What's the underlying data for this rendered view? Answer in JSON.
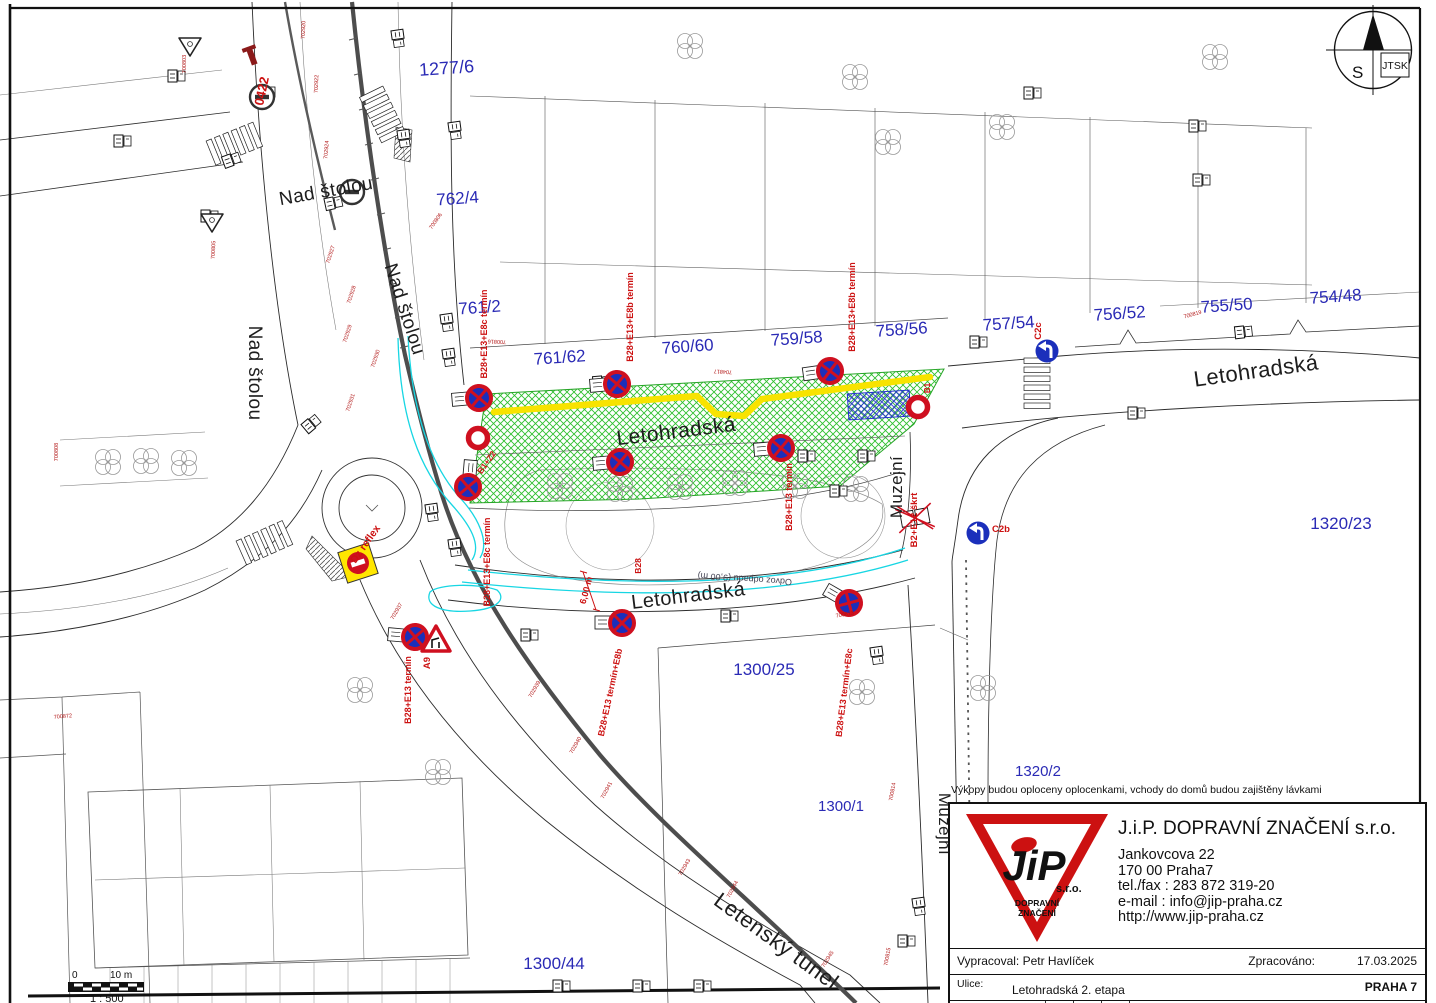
{
  "colors": {
    "parcel_blue": "#2a2ab5",
    "sign_red": "#cf1020",
    "label_red": "#cc1111",
    "sign_blue": "#1b2fbb",
    "workzone_green": "#2fbf2f",
    "closure_yellow": "#f8e300",
    "detour_cyan": "#17d6e3",
    "logo_red": "#cc1111"
  },
  "compass": {
    "s_label": "S",
    "grid_label": "JTSK"
  },
  "scale_bar": {
    "zero": "0",
    "ten": "10 m",
    "ratio": "1 : 500"
  },
  "note": "Výkopy budou oploceny oplocenkami, vchody do domů budou zajištěny lávkami",
  "title_block": {
    "company": "J.i.P. DOPRAVNÍ ZNAČENÍ s.r.o.",
    "address_lines": [
      "Jankovcova 22",
      "170 00 Praha7",
      "tel./fax : 283 872 319-20",
      "e-mail : info@jip-praha.cz",
      "http://www.jip-praha.cz"
    ],
    "logo": {
      "text": "JiP",
      "sro": "s.r.o.",
      "line1": "DOPRAVNÍ",
      "line2": "ZNAČENÍ"
    },
    "prepared_by_label": "Vypracoval:",
    "prepared_by": "Petr Havlíček",
    "processed_label": "Zpracováno:",
    "processed_date": "17.03.2025",
    "street_label": "Ulice:",
    "street": "Letohradská 2. etapa",
    "city": "PRAHA 7",
    "sheet_label": "Číslo listu",
    "sheet_number": "1"
  },
  "map": {
    "parcels": [
      {
        "t": "1277/6",
        "x": 447,
        "y": 74,
        "r": -4,
        "s": 18
      },
      {
        "t": "762/4",
        "x": 458,
        "y": 204,
        "r": -4,
        "s": 17
      },
      {
        "t": "761/2",
        "x": 480,
        "y": 313,
        "r": -4,
        "s": 17
      },
      {
        "t": "761/62",
        "x": 560,
        "y": 363,
        "r": -4,
        "s": 17
      },
      {
        "t": "760/60",
        "x": 688,
        "y": 352,
        "r": -4,
        "s": 17
      },
      {
        "t": "759/58",
        "x": 797,
        "y": 344,
        "r": -4,
        "s": 17
      },
      {
        "t": "758/56",
        "x": 902,
        "y": 335,
        "r": -4,
        "s": 17
      },
      {
        "t": "757/54",
        "x": 1009,
        "y": 329,
        "r": -4,
        "s": 17
      },
      {
        "t": "756/52",
        "x": 1120,
        "y": 319,
        "r": -4,
        "s": 17
      },
      {
        "t": "755/50",
        "x": 1227,
        "y": 311,
        "r": -4,
        "s": 17
      },
      {
        "t": "754/48",
        "x": 1336,
        "y": 302,
        "r": -4,
        "s": 17
      },
      {
        "t": "1320/23",
        "x": 1341,
        "y": 529,
        "r": 0,
        "s": 17
      },
      {
        "t": "1320/2",
        "x": 1038,
        "y": 776,
        "r": 0,
        "s": 15
      },
      {
        "t": "1300/25",
        "x": 764,
        "y": 675,
        "r": 0,
        "s": 17
      },
      {
        "t": "1300/1",
        "x": 841,
        "y": 811,
        "r": 0,
        "s": 15
      },
      {
        "t": "1300/44",
        "x": 554,
        "y": 969,
        "r": 0,
        "s": 17
      }
    ],
    "street_labels": [
      {
        "t": "Nad štolou",
        "x": 327,
        "y": 197,
        "r": -10,
        "s": 19
      },
      {
        "t": "Nad štolou",
        "x": 249,
        "y": 373,
        "r": 90,
        "s": 19
      },
      {
        "t": "Nad štolou",
        "x": 399,
        "y": 311,
        "r": 72,
        "s": 19
      },
      {
        "t": "Letohradská",
        "x": 677,
        "y": 438,
        "r": -7,
        "s": 21
      },
      {
        "t": "Letohradská",
        "x": 1257,
        "y": 378,
        "r": -8,
        "s": 22
      },
      {
        "t": "Letohradská",
        "x": 689,
        "y": 602,
        "r": -7,
        "s": 20
      },
      {
        "t": "Muzejní",
        "x": 902,
        "y": 487,
        "r": -90,
        "s": 17
      },
      {
        "t": "Muzejní",
        "x": 939,
        "y": 824,
        "r": 90,
        "s": 17
      },
      {
        "t": "Letenský tunel",
        "x": 772,
        "y": 947,
        "r": 36,
        "s": 22
      }
    ],
    "red_labels": [
      {
        "t": "0422",
        "x": 266,
        "y": 92,
        "r": -78,
        "s": 13
      },
      {
        "t": "B28+E13+E8c termín",
        "x": 487,
        "y": 334,
        "r": -90,
        "s": 9
      },
      {
        "t": "B28+E13+E8b termín",
        "x": 633,
        "y": 317,
        "r": -90,
        "s": 9
      },
      {
        "t": "B28+E13+E8b termín",
        "x": 855,
        "y": 307,
        "r": -90,
        "s": 9
      },
      {
        "t": "C2c",
        "x": 1041,
        "y": 331,
        "r": -90,
        "s": 9.5
      },
      {
        "t": "B1+Z2",
        "x": 489,
        "y": 464,
        "r": -55,
        "s": 8.5
      },
      {
        "t": "B28+E13+E8c termín",
        "x": 490,
        "y": 562,
        "r": -90,
        "s": 9
      },
      {
        "t": "B28+E13 termín",
        "x": 792,
        "y": 497,
        "r": -90,
        "s": 9
      },
      {
        "t": "B2+E12 škrt",
        "x": 917,
        "y": 520,
        "r": -90,
        "s": 9.5
      },
      {
        "t": "Dz reflex",
        "x": 368,
        "y": 546,
        "r": -55,
        "s": 10.5
      },
      {
        "t": "B28+E13 termín",
        "x": 411,
        "y": 690,
        "r": -90,
        "s": 9
      },
      {
        "t": "A9",
        "x": 430,
        "y": 663,
        "r": -90,
        "s": 9.5
      },
      {
        "t": "B28+E13 termín+E8b",
        "x": 613,
        "y": 693,
        "r": -78,
        "s": 9
      },
      {
        "t": "B28+E13 termín+E8c",
        "x": 847,
        "y": 693,
        "r": -83,
        "s": 9
      },
      {
        "t": "C2b",
        "x": 1001,
        "y": 532,
        "r": 0,
        "s": 9.5
      },
      {
        "t": "B1",
        "x": 930,
        "y": 388,
        "r": -90,
        "s": 8
      },
      {
        "t": "6,00 m",
        "x": 589,
        "y": 591,
        "r": -75,
        "s": 9
      },
      {
        "t": "B28",
        "x": 641,
        "y": 566,
        "r": -90,
        "s": 8.5
      }
    ],
    "survey_points": [
      {
        "t": "702920",
        "x": 305,
        "y": 30,
        "r": -88
      },
      {
        "t": "702922",
        "x": 318,
        "y": 84,
        "r": -88
      },
      {
        "t": "702924",
        "x": 328,
        "y": 150,
        "r": -85
      },
      {
        "t": "700803",
        "x": 186,
        "y": 64,
        "r": -90
      },
      {
        "t": "700805",
        "x": 215,
        "y": 250,
        "r": -88
      },
      {
        "t": "700806",
        "x": 437,
        "y": 222,
        "r": -55
      },
      {
        "t": "700808",
        "x": 58,
        "y": 452,
        "r": -90
      },
      {
        "t": "702927",
        "x": 332,
        "y": 255,
        "r": -72
      },
      {
        "t": "702928",
        "x": 353,
        "y": 295,
        "r": -72
      },
      {
        "t": "702929",
        "x": 349,
        "y": 334,
        "r": -72
      },
      {
        "t": "702930",
        "x": 377,
        "y": 359,
        "r": -72
      },
      {
        "t": "702931",
        "x": 352,
        "y": 403,
        "r": -72
      },
      {
        "t": "700816",
        "x": 497,
        "y": 340,
        "r": 182
      },
      {
        "t": "704817",
        "x": 723,
        "y": 370,
        "r": 183
      },
      {
        "t": "700819",
        "x": 1193,
        "y": 316,
        "r": -15
      },
      {
        "t": "700872",
        "x": 63,
        "y": 718,
        "r": -5
      },
      {
        "t": "702937",
        "x": 398,
        "y": 612,
        "r": -60
      },
      {
        "t": "702939",
        "x": 536,
        "y": 690,
        "r": -60
      },
      {
        "t": "702940",
        "x": 577,
        "y": 746,
        "r": -60
      },
      {
        "t": "702941",
        "x": 608,
        "y": 791,
        "r": -62
      },
      {
        "t": "702943",
        "x": 686,
        "y": 868,
        "r": -60
      },
      {
        "t": "702944",
        "x": 734,
        "y": 890,
        "r": -62
      },
      {
        "t": "702945",
        "x": 829,
        "y": 960,
        "r": -58
      },
      {
        "t": "700815",
        "x": 889,
        "y": 957,
        "r": -80
      },
      {
        "t": "700814",
        "x": 894,
        "y": 792,
        "r": -80
      },
      {
        "t": "700813",
        "x": 845,
        "y": 616,
        "r": -10
      }
    ],
    "b28_signs": [
      {
        "x": 479,
        "y": 398,
        "r": -5
      },
      {
        "x": 617,
        "y": 384,
        "r": -5
      },
      {
        "x": 830,
        "y": 371,
        "r": -8
      },
      {
        "x": 468,
        "y": 487,
        "r": 95
      },
      {
        "x": 620,
        "y": 462,
        "r": -5
      },
      {
        "x": 781,
        "y": 448,
        "r": -5
      },
      {
        "x": 415,
        "y": 637,
        "r": 5
      },
      {
        "x": 622,
        "y": 623,
        "r": 0
      },
      {
        "x": 849,
        "y": 603,
        "r": 30
      }
    ],
    "ring_signs": [
      {
        "x": 478,
        "y": 438
      },
      {
        "x": 918,
        "y": 407
      }
    ],
    "blue_arrow_signs": [
      {
        "x": 1047,
        "y": 351
      },
      {
        "x": 978,
        "y": 533
      }
    ],
    "warning_triangles": [
      {
        "x": 436,
        "y": 641
      }
    ],
    "no_entry_yellow": [
      {
        "x": 358,
        "y": 563,
        "r": -18
      }
    ],
    "crossed_signs": [
      {
        "x": 915,
        "y": 518,
        "r": -10
      }
    ],
    "no_entry_plain": [
      {
        "x": 352,
        "y": 192
      },
      {
        "x": 262,
        "y": 97
      }
    ],
    "yield_signs": [
      {
        "x": 190,
        "y": 46
      },
      {
        "x": 212,
        "y": 222
      }
    ],
    "trees": [
      {
        "x": 690,
        "y": 46
      },
      {
        "x": 855,
        "y": 77
      },
      {
        "x": 888,
        "y": 142
      },
      {
        "x": 1002,
        "y": 127
      },
      {
        "x": 1215,
        "y": 57
      },
      {
        "x": 108,
        "y": 462
      },
      {
        "x": 146,
        "y": 461
      },
      {
        "x": 184,
        "y": 463
      },
      {
        "x": 560,
        "y": 486
      },
      {
        "x": 620,
        "y": 489
      },
      {
        "x": 680,
        "y": 487
      },
      {
        "x": 735,
        "y": 483
      },
      {
        "x": 795,
        "y": 486
      },
      {
        "x": 856,
        "y": 489
      },
      {
        "x": 360,
        "y": 690
      },
      {
        "x": 438,
        "y": 772
      },
      {
        "x": 862,
        "y": 692
      },
      {
        "x": 983,
        "y": 688
      }
    ],
    "zebras": [
      {
        "x": 236,
        "y": 143,
        "r": -22
      },
      {
        "x": 383,
        "y": 116,
        "r": 64
      },
      {
        "x": 1037,
        "y": 385,
        "r": 90
      },
      {
        "x": 266,
        "y": 542,
        "r": -24
      }
    ],
    "sign_clusters": [
      {
        "x": 176,
        "y": 76,
        "r": 0
      },
      {
        "x": 266,
        "y": 92,
        "r": 0
      },
      {
        "x": 231,
        "y": 160,
        "r": -20
      },
      {
        "x": 333,
        "y": 203,
        "r": -12
      },
      {
        "x": 404,
        "y": 138,
        "r": 82
      },
      {
        "x": 398,
        "y": 38,
        "r": 82
      },
      {
        "x": 209,
        "y": 216,
        "r": 0
      },
      {
        "x": 122,
        "y": 141,
        "r": 0
      },
      {
        "x": 311,
        "y": 424,
        "r": -40
      },
      {
        "x": 447,
        "y": 322,
        "r": 82
      },
      {
        "x": 449,
        "y": 357,
        "r": 82
      },
      {
        "x": 432,
        "y": 512,
        "r": 82
      },
      {
        "x": 455,
        "y": 547,
        "r": 82
      },
      {
        "x": 601,
        "y": 382,
        "r": -5
      },
      {
        "x": 806,
        "y": 456,
        "r": 0
      },
      {
        "x": 838,
        "y": 491,
        "r": 0
      },
      {
        "x": 866,
        "y": 456,
        "r": 0
      },
      {
        "x": 1136,
        "y": 413,
        "r": 0
      },
      {
        "x": 1243,
        "y": 332,
        "r": -6
      },
      {
        "x": 529,
        "y": 635,
        "r": 0
      },
      {
        "x": 729,
        "y": 616,
        "r": 0
      },
      {
        "x": 877,
        "y": 655,
        "r": 82
      },
      {
        "x": 919,
        "y": 906,
        "r": 82
      },
      {
        "x": 906,
        "y": 941,
        "r": 0
      },
      {
        "x": 641,
        "y": 986,
        "r": 0
      },
      {
        "x": 702,
        "y": 986,
        "r": 0
      },
      {
        "x": 561,
        "y": 986,
        "r": 0
      },
      {
        "x": 1032,
        "y": 93,
        "r": 0
      },
      {
        "x": 1197,
        "y": 126,
        "r": 0
      },
      {
        "x": 1201,
        "y": 180,
        "r": 0
      },
      {
        "x": 455,
        "y": 130,
        "r": 82
      },
      {
        "x": 978,
        "y": 342,
        "r": 0
      }
    ],
    "mirrored_text": {
      "t": "Odvoz odpadu (9,00 m)",
      "x": 745,
      "y": 576,
      "r": 184,
      "s": 9
    }
  }
}
